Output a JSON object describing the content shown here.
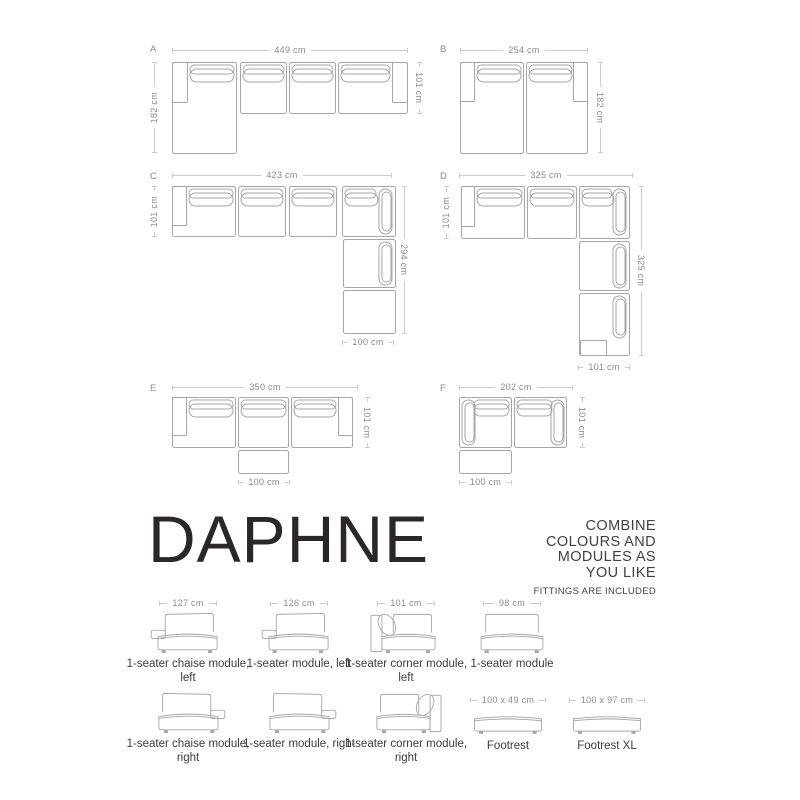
{
  "title": {
    "product_name": "DAPHNE"
  },
  "tagline": {
    "lines": [
      "COMBINE",
      "COLOURS AND",
      "MODULES AS",
      "YOU LIKE"
    ],
    "note": "FITTINGS ARE INCLUDED"
  },
  "configurations": [
    {
      "id": "A",
      "top_dim": "449 cm",
      "left_dim": "182 cm",
      "right_dim": "101 cm"
    },
    {
      "id": "B",
      "top_dim": "254 cm",
      "right_dim": "182 cm"
    },
    {
      "id": "C",
      "top_dim": "423 cm",
      "left_dim": "101 cm",
      "right_dim": "294 cm",
      "bottom_dim": "100 cm"
    },
    {
      "id": "D",
      "top_dim": "325 cm",
      "left_dim": "101 cm",
      "right_dim": "325 cm",
      "bottom_dim": "101 cm"
    },
    {
      "id": "E",
      "top_dim": "350 cm",
      "right_dim": "101 cm",
      "bottom_dim": "100 cm"
    },
    {
      "id": "F",
      "top_dim": "202 cm",
      "right_dim": "101 cm",
      "bottom_dim": "100 cm"
    }
  ],
  "modules_row1": [
    {
      "dim": "127 cm",
      "label": "1-seater chaise module, left"
    },
    {
      "dim": "126 cm",
      "label": "1-seater module, left"
    },
    {
      "dim": "101 cm",
      "label": "1-seater corner module, left"
    },
    {
      "dim": "98 cm",
      "label": "1-seater module"
    }
  ],
  "modules_row2": [
    {
      "label": "1-seater chaise module, right"
    },
    {
      "label": "1-seater module, right"
    },
    {
      "label": "1-seater corner module, right"
    },
    {
      "dim": "100 x 49 cm",
      "label": "Footrest"
    },
    {
      "dim": "100 x 97 cm",
      "label": "Footrest XL"
    }
  ],
  "colors": {
    "background": "#ffffff",
    "line_art": "#a6a6a6",
    "dim_line": "#cccccc",
    "dim_text": "#8a8a8a",
    "title_text": "#2b2728",
    "body_text": "#3e3a3b"
  }
}
